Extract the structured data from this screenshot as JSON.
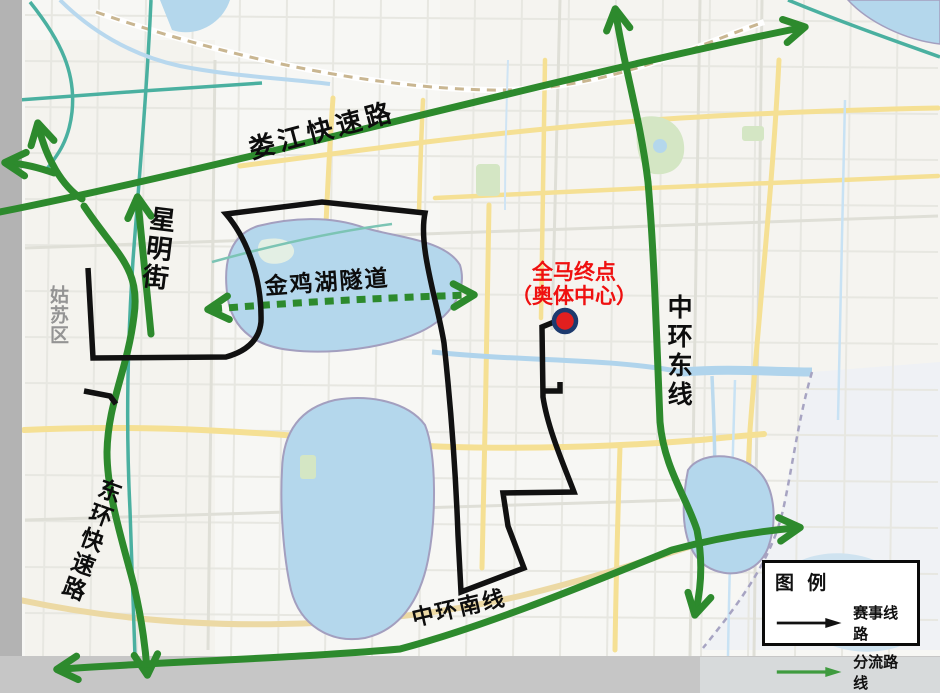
{
  "labels": {
    "loujiang_expressway": "娄江快速路",
    "xingming_street": "星明街",
    "jinji_lake_tunnel": "金鸡湖隧道",
    "middle_ring_east": "中环东线",
    "east_ring_expressway": "东环快速路",
    "middle_ring_south": "中环南线",
    "district": "姑苏区",
    "finish_line1": "全马终点",
    "finish_line2": "（奥体中心）"
  },
  "legend": {
    "title": "图 例",
    "items": [
      {
        "label": "赛事线路",
        "color": "#111111"
      },
      {
        "label": "分流路线",
        "color": "#3f9b3f"
      }
    ]
  },
  "colors": {
    "race_route": "#111111",
    "diversion_route": "#2d8a2d",
    "finish_text": "#ef1010",
    "finish_marker_fill": "#e21f1f",
    "finish_marker_ring": "#1d3a6e",
    "water": "#b4d7ec",
    "major_road": "#f5e094",
    "district_label": "#949494"
  }
}
